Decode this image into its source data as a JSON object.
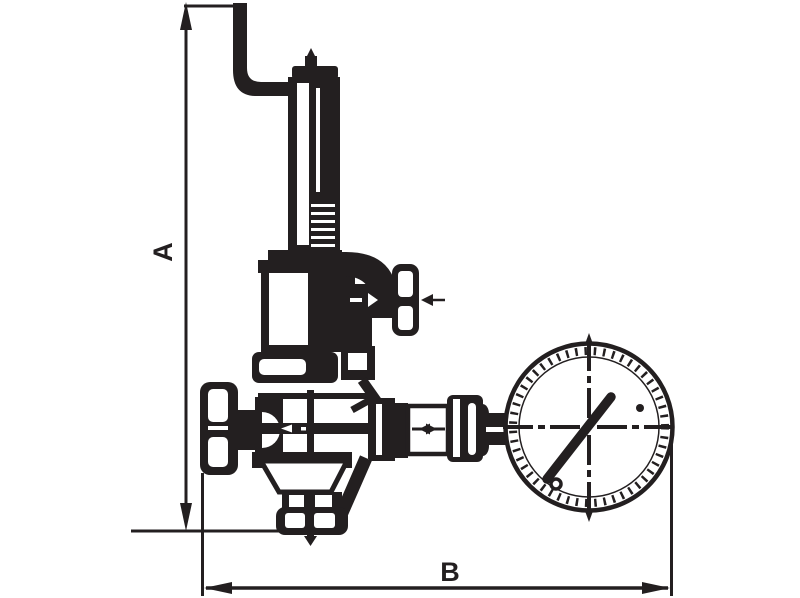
{
  "drawing": {
    "labels": {
      "vertical_dimension": "A",
      "horizontal_dimension": "B"
    },
    "colors": {
      "ink": "#231f20",
      "background": "#ffffff"
    }
  }
}
